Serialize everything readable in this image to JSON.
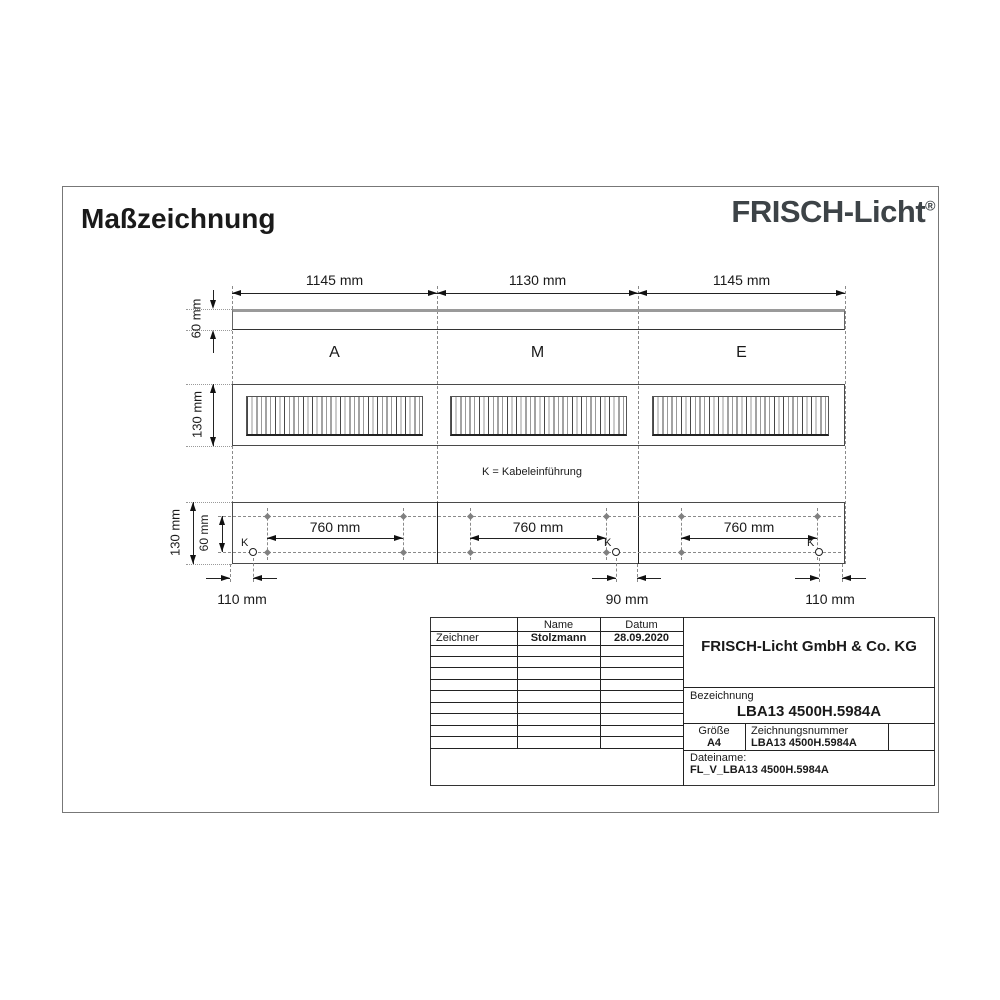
{
  "page": {
    "title": "Maßzeichnung",
    "brand": "FRISCH-Licht",
    "brand_reg": "®"
  },
  "colors": {
    "brand": "#3d4347",
    "line": "#222222",
    "aux": "#8a8a8a"
  },
  "drawing": {
    "top_dims": [
      "1145 mm",
      "1130 mm",
      "1145 mm"
    ],
    "side_height": "60 mm",
    "section_labels": [
      "A",
      "M",
      "E"
    ],
    "front_height": "130 mm",
    "note": "K = Kabeleinführung",
    "bottom": {
      "height": "130 mm",
      "inner_height": "60 mm",
      "spans": [
        "760 mm",
        "760 mm",
        "760 mm"
      ],
      "k": [
        "K",
        "K",
        "K"
      ],
      "offsets": [
        "110 mm",
        "90 mm",
        "110 mm"
      ]
    }
  },
  "title_block": {
    "header": {
      "name": "Name",
      "datum": "Datum"
    },
    "row1": {
      "role": "Zeichner",
      "name": "Stolzmann",
      "datum": "28.09.2020"
    },
    "company": "FRISCH-Licht GmbH & Co. KG",
    "bezeichnung_label": "Bezeichnung",
    "bezeichnung_value": "LBA13 4500H.5984A",
    "groesse_label": "Größe",
    "groesse_value": "A4",
    "zeichnungsnummer_label": "Zeichnungsnummer",
    "zeichnungsnummer_value": "LBA13 4500H.5984A",
    "dateiname_label": "Dateiname:",
    "dateiname_value": "FL_V_LBA13 4500H.5984A"
  }
}
